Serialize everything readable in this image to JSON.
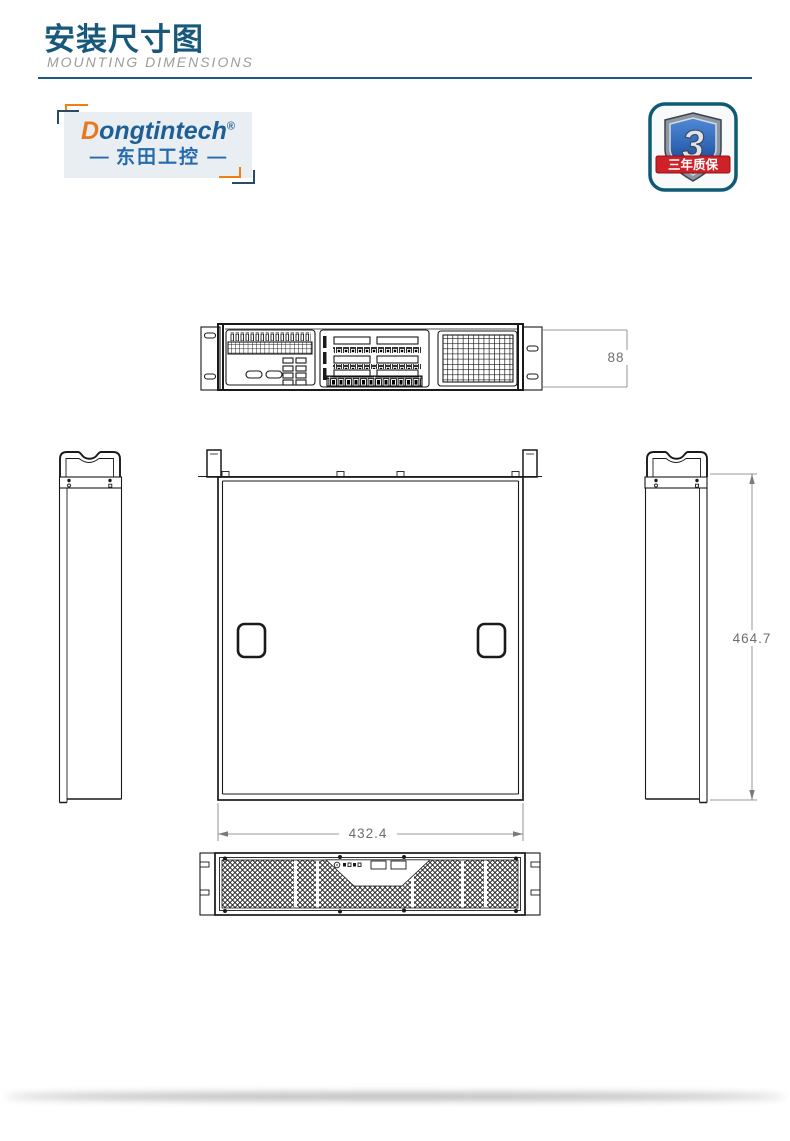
{
  "header": {
    "title_cn": "安装尺寸图",
    "title_en": "MOUNTING DIMENSIONS"
  },
  "logo": {
    "brand_initial": "D",
    "brand_rest": "ongtintech",
    "registered": "®",
    "left_dash": "—",
    "brand_cn": "东田工控",
    "right_dash": "—"
  },
  "warranty_badge": {
    "number": "3",
    "label": "三年质保"
  },
  "drawing": {
    "dims": {
      "height_mm": "88",
      "width_mm": "432.4",
      "depth_mm": "464.7"
    }
  },
  "colors": {
    "accent_blue": "#17587b",
    "divider_blue": "#1d5c80",
    "subtitle_gray": "#9c9c9c",
    "logo_orange": "#e8791d",
    "logo_blue": "#2569ae",
    "badge_border_teal": "#0d5a74",
    "badge_shield_blue": "#2f66b5",
    "badge_ribbon_red": "#cf2128",
    "cad_line": "#1a1a1a",
    "dim_gray": "#6e6e6e"
  }
}
